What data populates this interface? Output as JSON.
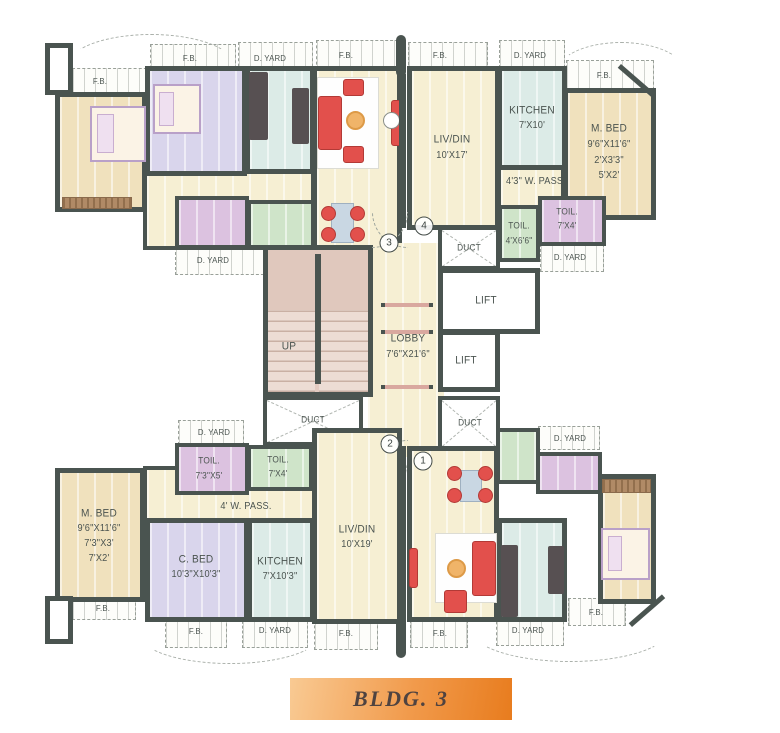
{
  "banner": {
    "text": "BLDG. 3"
  },
  "markers": {
    "c1": "1",
    "c2": "2",
    "c3": "3",
    "c4": "4"
  },
  "core": {
    "lobby_name": "LOBBY",
    "lobby_dims": "7'6\"X21'6\"",
    "lift": "LIFT",
    "duct": "DUCT",
    "up": "UP"
  },
  "strips": {
    "fb": "F.B.",
    "dyard": "D. YARD"
  },
  "flat_tr": {
    "livdin_name": "LIV/DIN",
    "livdin_dims": "10'X17'",
    "kitchen_name": "KITCHEN",
    "kitchen_dims": "7'X10'",
    "mbed_name": "M. BED",
    "mbed_dim1": "9'6\"X11'6\"",
    "mbed_dim2": "2'X3'3\"",
    "mbed_dim3": "5'X2'",
    "wpass": "4'3\" W. PASS.",
    "toil_green_name": "TOIL.",
    "toil_green_dims": "4'X6'6\"",
    "toil_pink_name": "TOIL.",
    "toil_pink_dims": "7'X4'"
  },
  "flat_bl": {
    "mbed_name": "M. BED",
    "mbed_dim1": "9'6\"X11'6\"",
    "mbed_dim2": "7'3\"X3'",
    "mbed_dim3": "7'X2'",
    "cbed_name": "C. BED",
    "cbed_dims": "10'3\"X10'3\"",
    "kitchen_name": "KITCHEN",
    "kitchen_dims": "7'X10'3\"",
    "livdin_name": "LIV/DIN",
    "livdin_dims": "10'X19'",
    "wpass": "4' W. PASS.",
    "toil_pink_name": "TOIL.",
    "toil_pink_dims": "7'3\"X5'",
    "toil_green_name": "TOIL.",
    "toil_green_dims": "7'X4'"
  }
}
